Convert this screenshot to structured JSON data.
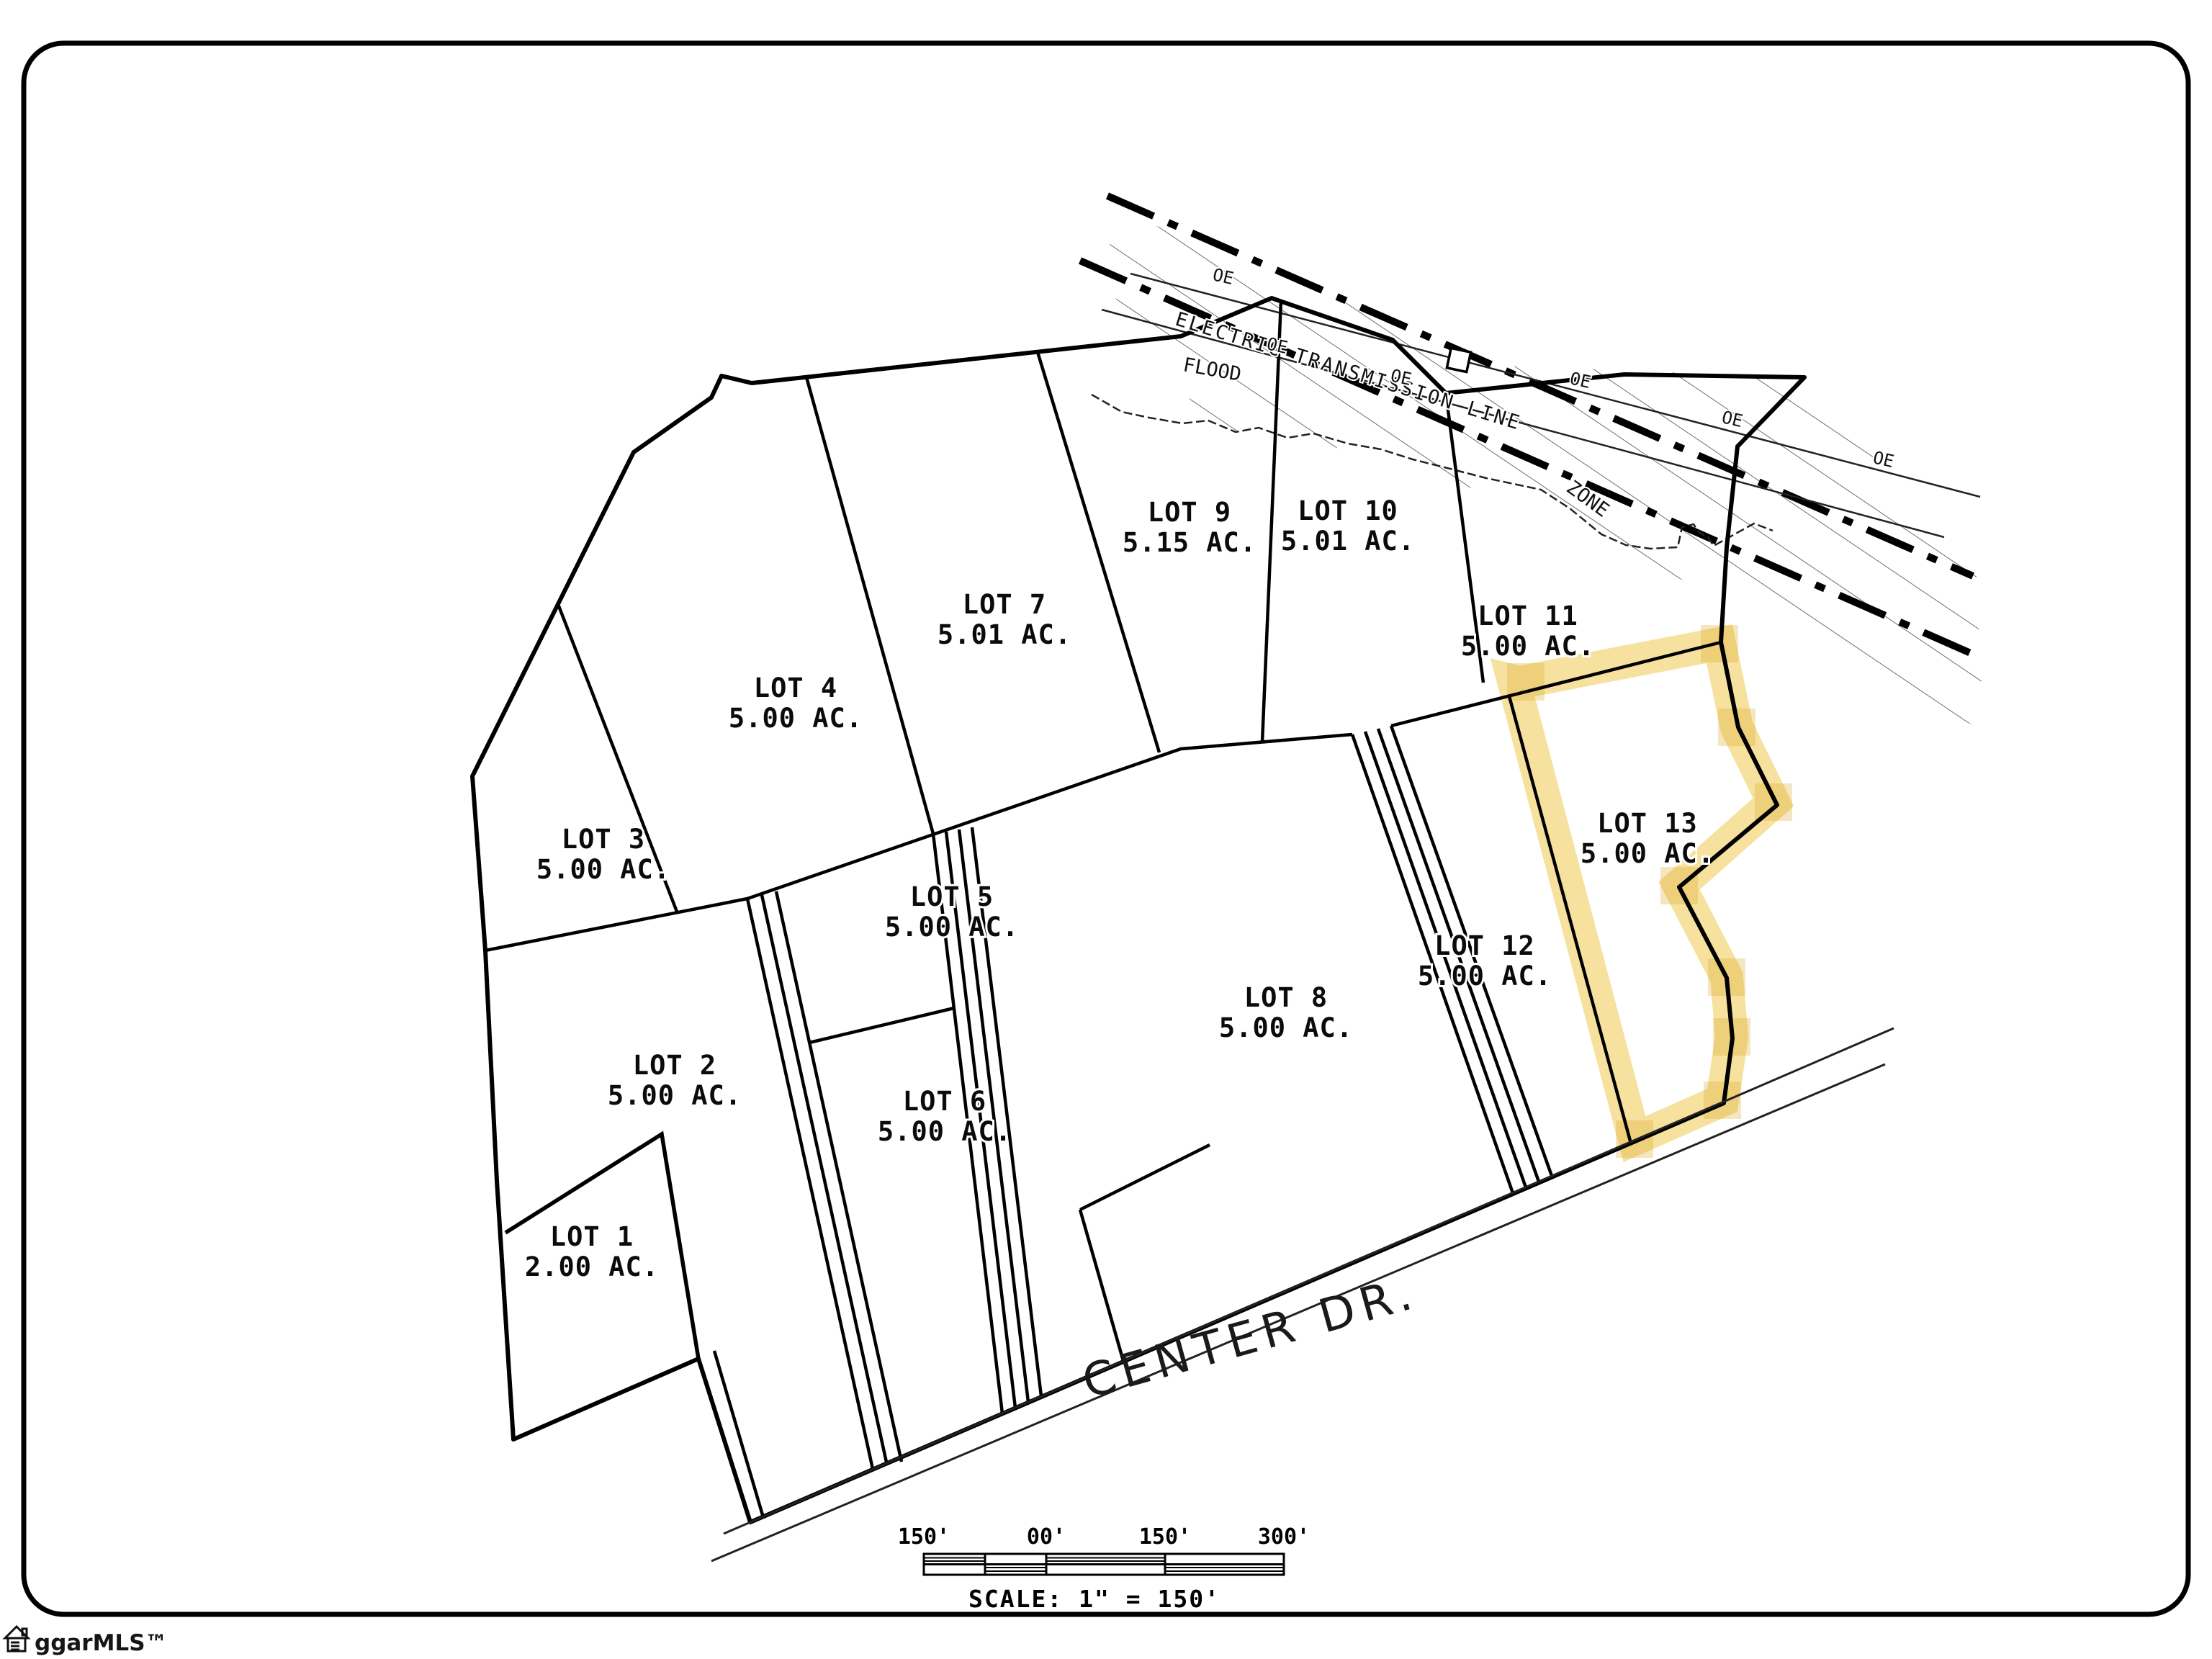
{
  "lots": [
    {
      "name": "LOT 1",
      "acreage": "2.00 AC."
    },
    {
      "name": "LOT 2",
      "acreage": "5.00 AC."
    },
    {
      "name": "LOT 3",
      "acreage": "5.00 AC."
    },
    {
      "name": "LOT 4",
      "acreage": "5.00 AC."
    },
    {
      "name": "LOT 5",
      "acreage": "5.00 AC."
    },
    {
      "name": "LOT 6",
      "acreage": "5.00 AC."
    },
    {
      "name": "LOT 7",
      "acreage": "5.01 AC."
    },
    {
      "name": "LOT 8",
      "acreage": "5.00 AC."
    },
    {
      "name": "LOT 9",
      "acreage": "5.15 AC."
    },
    {
      "name": "LOT 10",
      "acreage": "5.01 AC."
    },
    {
      "name": "LOT 11",
      "acreage": "5.00 AC."
    },
    {
      "name": "LOT 12",
      "acreage": "5.00 AC."
    },
    {
      "name": "LOT 13",
      "acreage": "5.00 AC."
    }
  ],
  "highlighted_lot": "LOT 13",
  "road": {
    "name": "CENTER DR."
  },
  "flood_zone": {
    "word1": "FLOOD",
    "word2": "ZONE"
  },
  "transmission": {
    "label": "ELECTRIC TRANSMISSION LINE",
    "marker": "OE"
  },
  "scale_bar": {
    "tick_labels": [
      "150'",
      "00'",
      "150'",
      "300'"
    ],
    "caption": "SCALE:  1\" = 150'"
  },
  "watermark": {
    "text": "ggarMLS™"
  },
  "colors": {
    "highlight": "#F0C84F",
    "line": "#000000",
    "hatch": "#555555"
  }
}
